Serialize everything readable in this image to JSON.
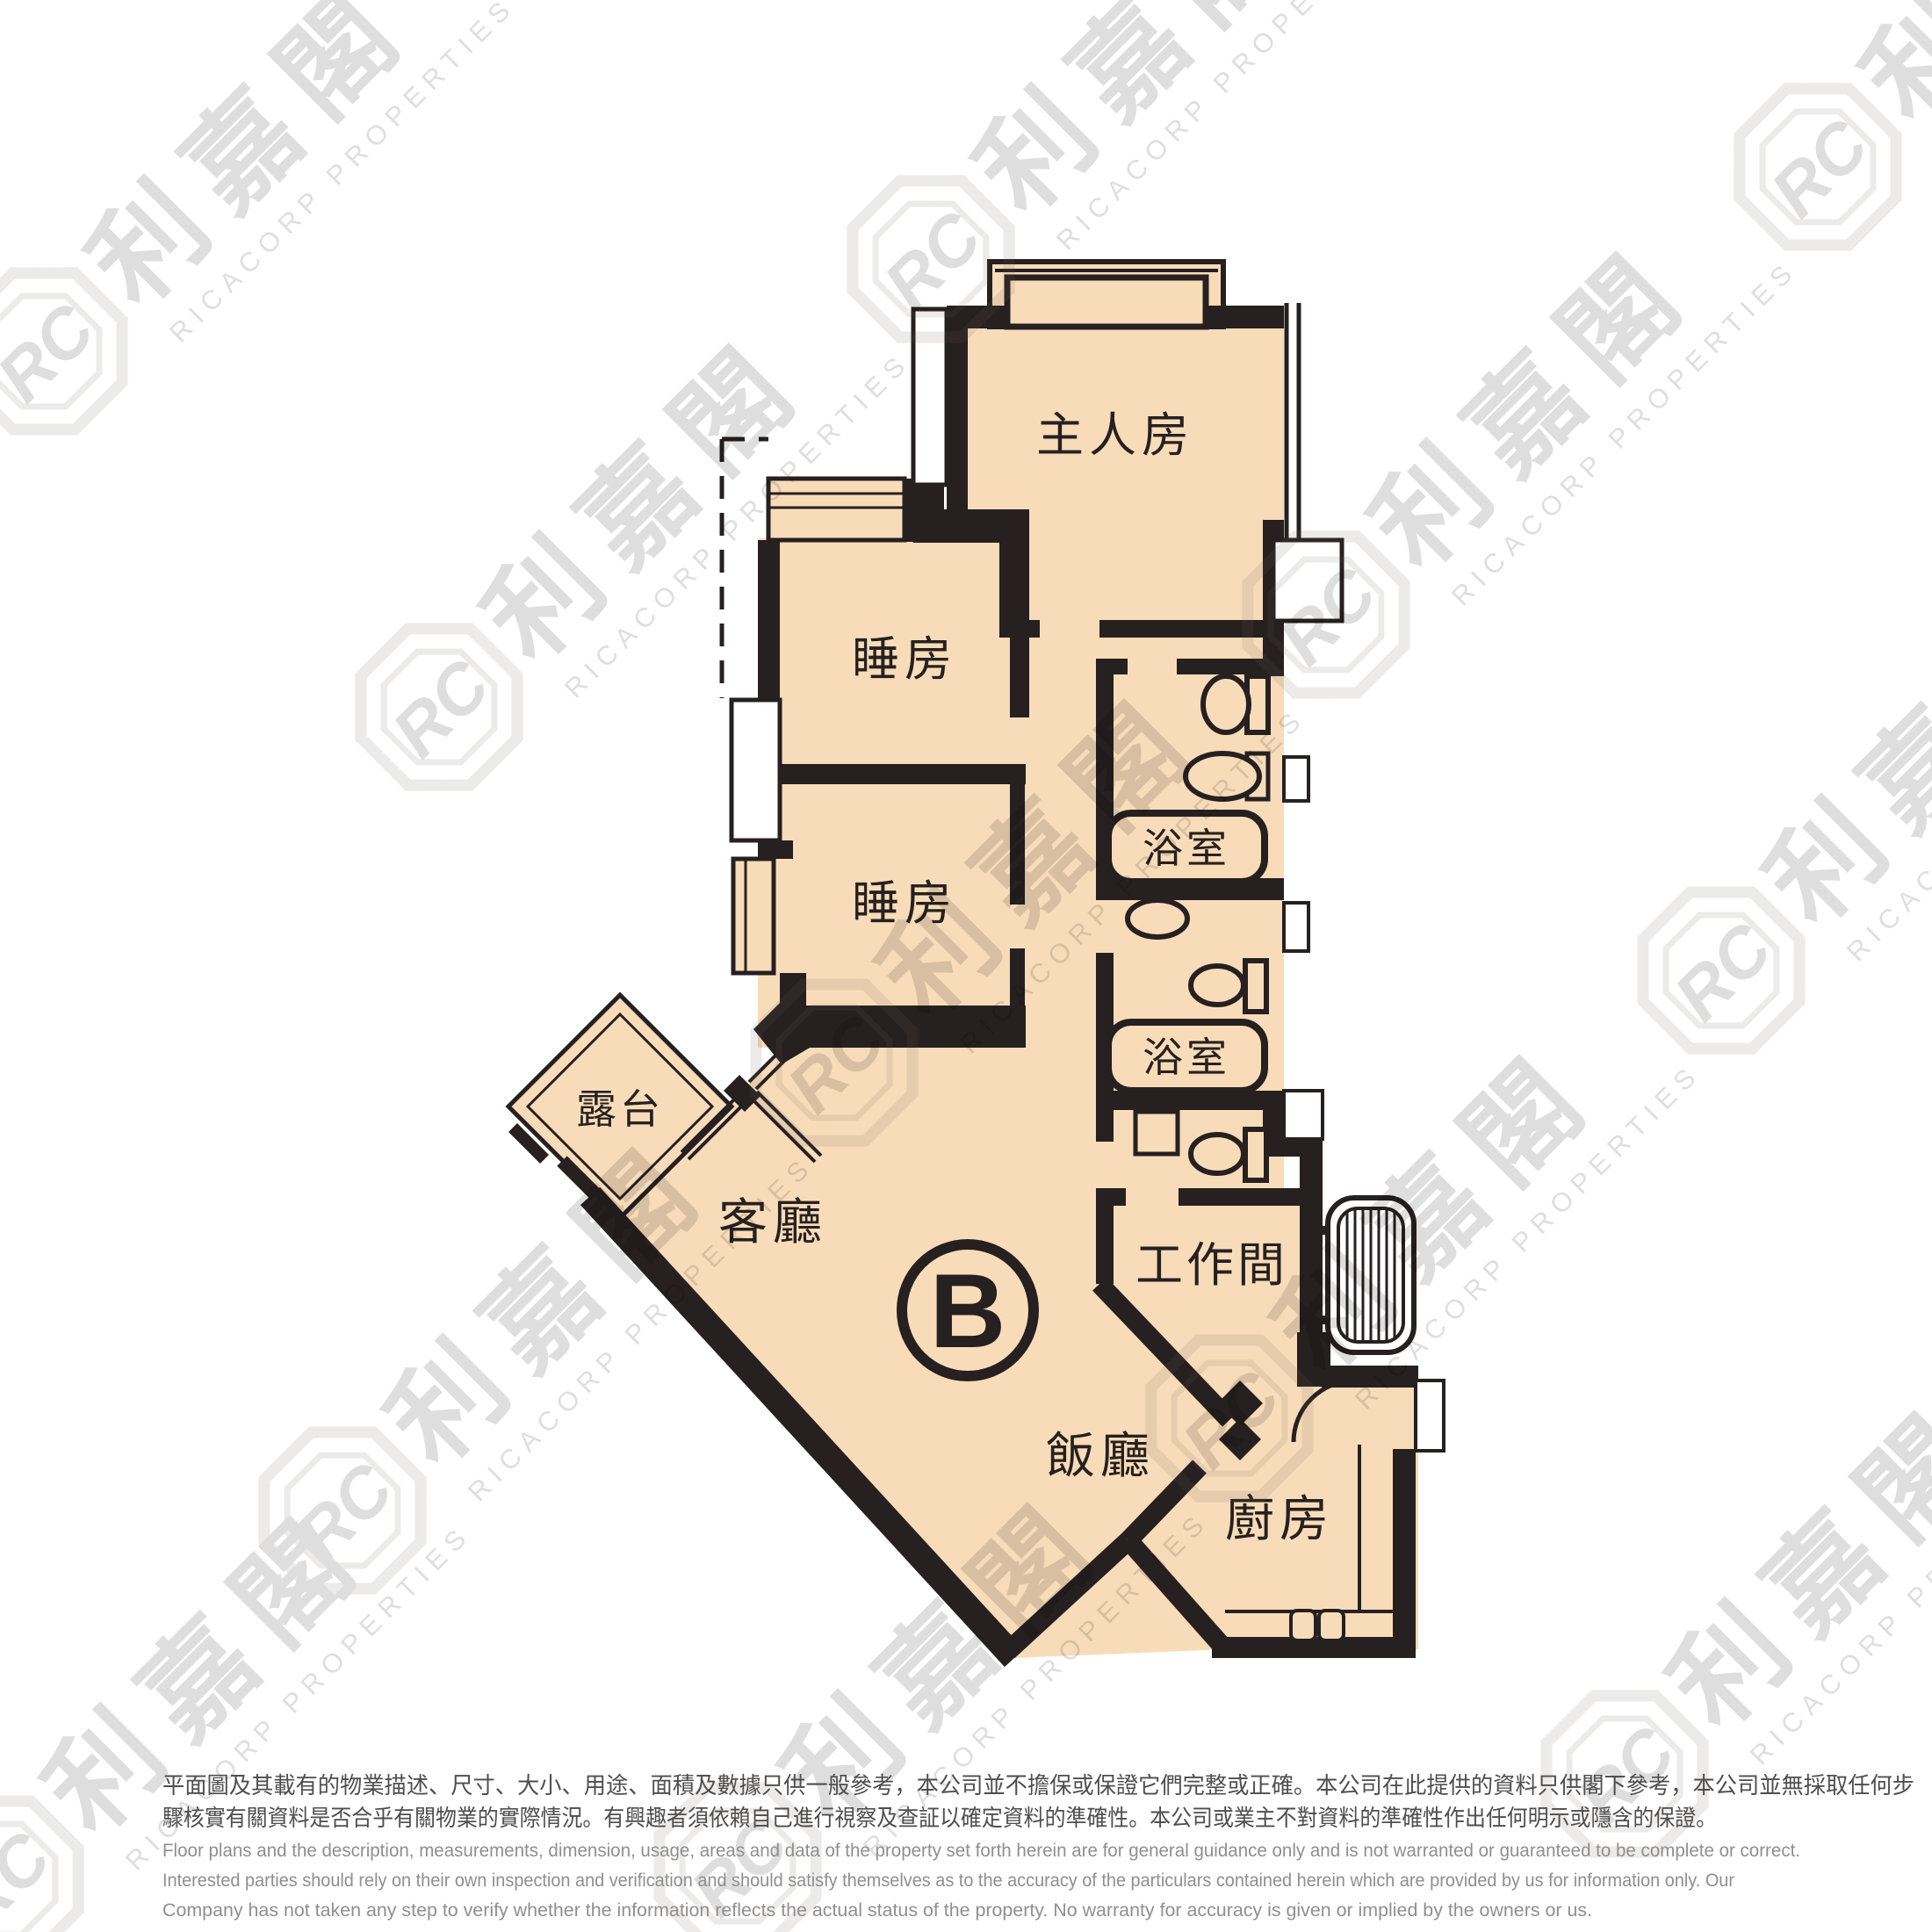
{
  "floor_plan": {
    "unit_label": "B",
    "rooms": {
      "master_bedroom": "主人房",
      "bedroom_1": "睡房",
      "bedroom_2": "睡房",
      "bathroom_1": "浴室",
      "bathroom_2": "浴室",
      "balcony": "露台",
      "living_room": "客廳",
      "dining_room": "飯廳",
      "work_room": "工作間",
      "kitchen": "廚房"
    },
    "colors": {
      "floor_fill": "#F8DCB9",
      "wall": "#262020"
    }
  },
  "watermark": {
    "logo_initials": "RC",
    "logo_text": "利嘉閣",
    "company_text": "RICACORP PROPERTIES"
  },
  "disclaimer": {
    "chinese_line_1": "平面圖及其載有的物業描述、尺寸、大小、用途、面積及數據只供一般參考，本公司並不擔保或保證它們完整或正確。本公司在此提供的資料只供閣下參考，本公司並無採取任何步",
    "chinese_line_2": "驟核實有關資料是否合乎有關物業的實際情況。有興趣者須依賴自己進行視察及查証以確定資料的準確性。本公司或業主不對資料的準確性作出任何明示或隱含的保證。",
    "english_line_1": "Floor plans and the description, measurements, dimension, usage, areas and data of the property set forth herein are for general guidance only and is not warranted or guaranteed to be complete or correct.",
    "english_line_2": "Interested parties should rely on their own inspection and verification and should satisfy themselves as to the accuracy of the particulars contained herein which are provided by us for information only.  Our",
    "english_line_3": "Company has not taken any step to verify whether the information reflects the actual status of the property.  No warranty for accuracy is given or implied by the owners or us."
  }
}
